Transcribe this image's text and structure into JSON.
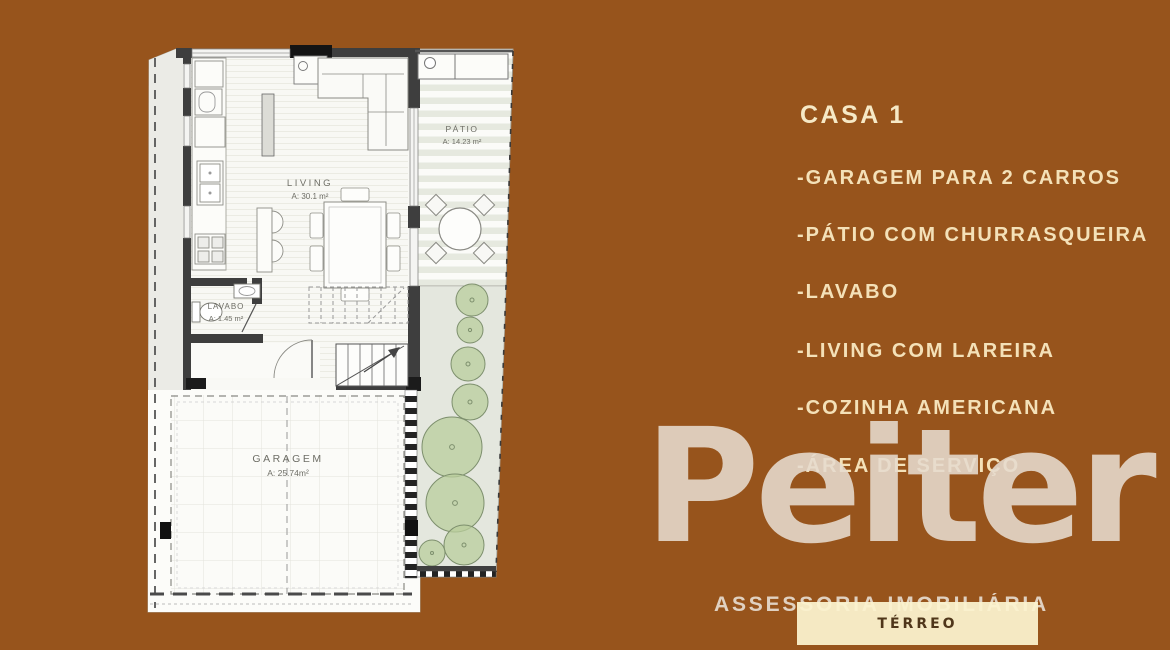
{
  "page": {
    "background": "#97541C"
  },
  "listing_panel": {
    "title": "CASA 1",
    "text_color": "#F4E1B8",
    "features": [
      "-GARAGEM PARA 2 CARROS",
      "-PÁTIO COM CHURRASQUEIRA",
      "-LAVABO",
      "-LIVING COM LAREIRA",
      "-COZINHA AMERICANA",
      "-ÁREA DE SERVIÇO"
    ]
  },
  "floor_plan": {
    "living": {
      "name": "LIVING",
      "area": "A: 30.1 m²"
    },
    "patio": {
      "name": "PÁTIO",
      "area": "A: 14.23 m²"
    },
    "lavabo": {
      "name": "LAVABO",
      "area": "A: 1.45 m²"
    },
    "garagem": {
      "name": "GARAGEM",
      "area": "A: 25.74m²"
    }
  },
  "watermark": {
    "brand": "Peiter",
    "subtitle": "ASSESSORIA IMOBILIÁRIA",
    "color": "#E7DCCF"
  },
  "floor_badge": {
    "label": "TÉRREO",
    "background": "#FBF2CE",
    "text_color": "#4F361A"
  }
}
